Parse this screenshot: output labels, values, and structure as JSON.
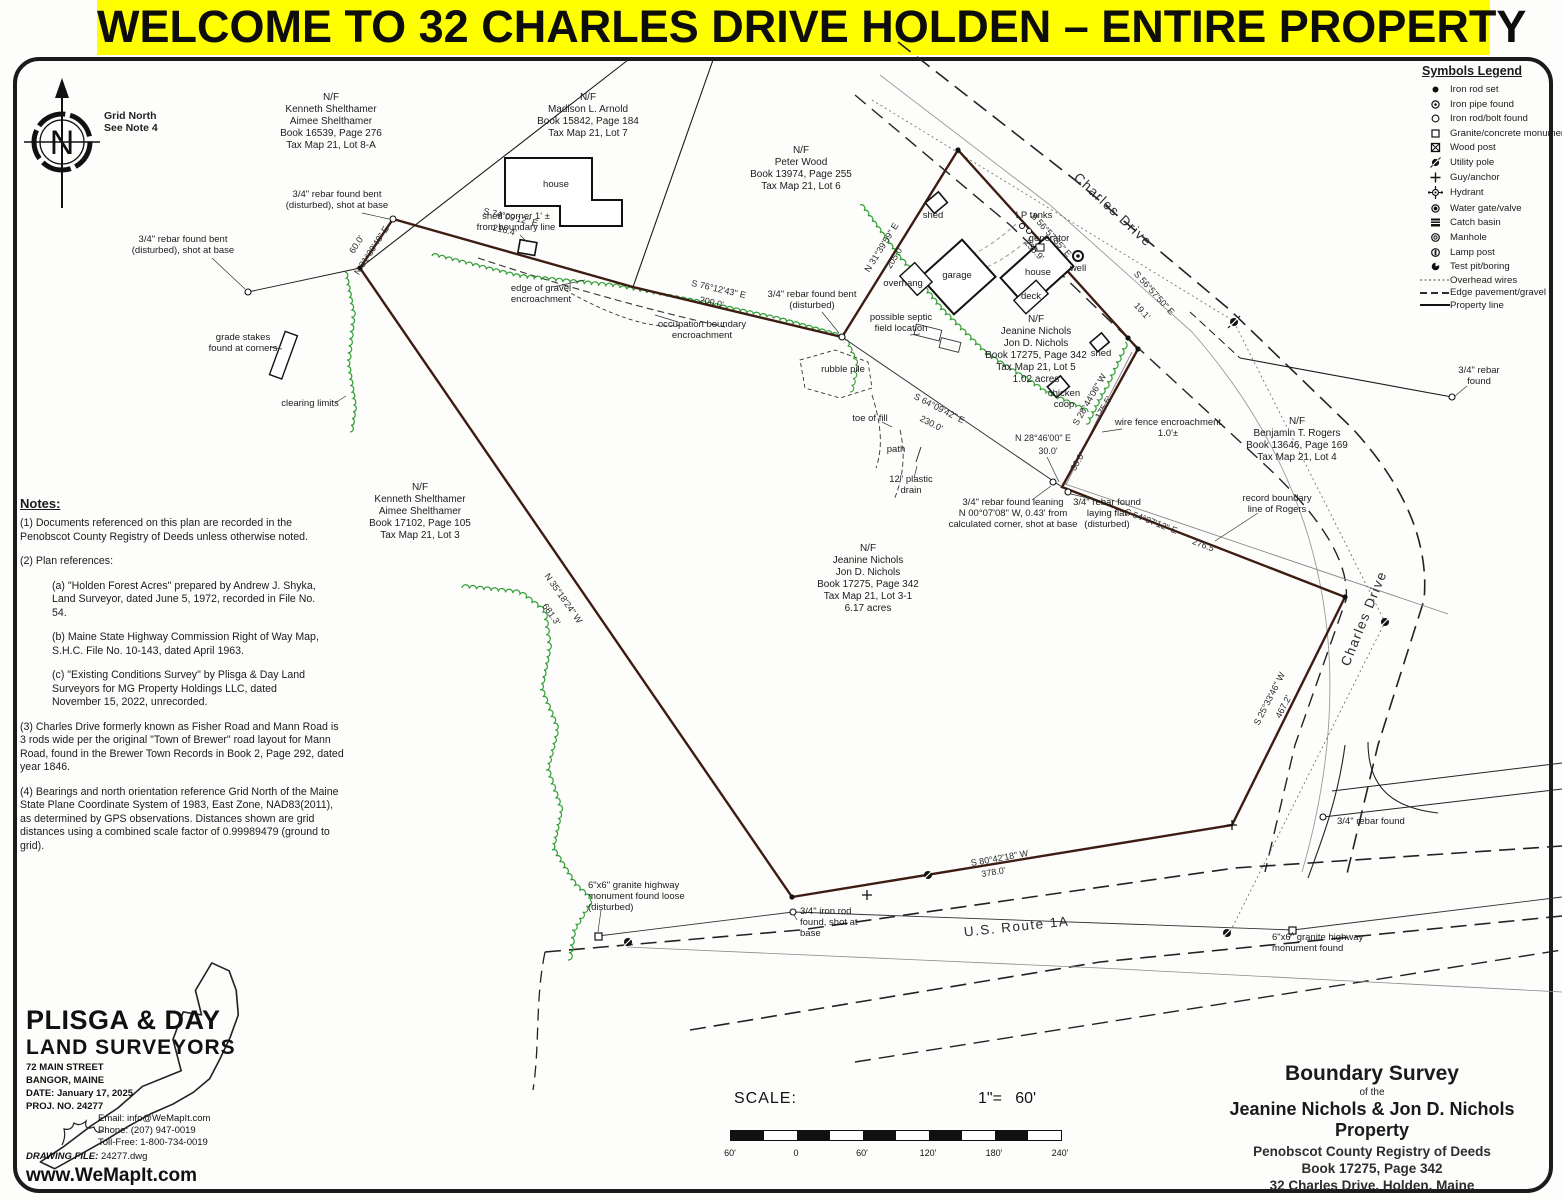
{
  "banner": {
    "text": "WELCOME TO 32 CHARLES DRIVE HOLDEN – ENTIRE PROPERTY"
  },
  "compass": {
    "letter": "N",
    "caption1": "Grid North",
    "caption2": "See Note 4"
  },
  "legend": {
    "title": "Symbols Legend",
    "items": [
      {
        "icon": "iron-rod-set",
        "label": "Iron rod set"
      },
      {
        "icon": "iron-pipe-found",
        "label": "Iron pipe found"
      },
      {
        "icon": "iron-rod-bolt-found",
        "label": "Iron rod/bolt found"
      },
      {
        "icon": "granite-concrete-monument",
        "label": "Granite/concrete monument"
      },
      {
        "icon": "wood-post",
        "label": "Wood post"
      },
      {
        "icon": "utility-pole",
        "label": "Utility pole"
      },
      {
        "icon": "guy-anchor",
        "label": "Guy/anchor"
      },
      {
        "icon": "hydrant",
        "label": "Hydrant"
      },
      {
        "icon": "water-gate-valve",
        "label": "Water gate/valve"
      },
      {
        "icon": "catch-basin",
        "label": "Catch basin"
      },
      {
        "icon": "manhole",
        "label": "Manhole"
      },
      {
        "icon": "lamp-post",
        "label": "Lamp post"
      },
      {
        "icon": "test-pit-boring",
        "label": "Test pit/boring"
      },
      {
        "icon": "overhead-wires",
        "label": "Overhead wires"
      },
      {
        "icon": "edge-pavement-gravel",
        "label": "Edge pavement/gravel"
      },
      {
        "icon": "property-line",
        "label": "Property line"
      }
    ]
  },
  "notes": {
    "title": "Notes:",
    "items": [
      {
        "text": "(1)  Documents referenced on this plan are recorded in the Penobscot County Registry of Deeds unless otherwise noted."
      },
      {
        "text": "(2) Plan references:"
      },
      {
        "text": "(a) \"Holden Forest Acres\" prepared by Andrew J. Shyka, Land Surveyor, dated June 5, 1972, recorded in File No. 54."
      },
      {
        "text": "(b) Maine State Highway Commission Right of Way Map, S.H.C. File No. 10-143, dated April 1963."
      },
      {
        "text": "(c) \"Existing Conditions Survey\" by Plisga & Day Land Surveyors for MG Property Holdings LLC, dated November 15, 2022, unrecorded."
      },
      {
        "text": "(3) Charles Drive formerly known as Fisher Road and Mann Road is 3 rods wide per the original \"Town of Brewer\" road layout for Mann Road, found in the Brewer Town Records in Book 2, Page 292, dated year 1846."
      },
      {
        "text": "(4) Bearings and north orientation reference Grid North of the Maine State Plane Coordinate System of 1983, East Zone, NAD83(2011), as determined by GPS observations. Distances shown are grid distances using a combined scale factor of 0.99989479 (ground to grid)."
      }
    ]
  },
  "firm": {
    "name1": "PLISGA & DAY",
    "name2": "LAND SURVEYORS",
    "addr1": "72 MAIN STREET",
    "addr2": "BANGOR, MAINE",
    "date_label": "DATE:",
    "date_value": "January 17, 2025",
    "proj_label": "PROJ. NO.",
    "proj_value": "24277",
    "email": "Email: info@WeMapIt.com",
    "phone": "Phone: (207) 947-0019",
    "tollfree": "Toll-Free: 1-800-734-0019",
    "file_label": "DRAWING FILE:",
    "file_value": "24277.dwg",
    "website": "www.WeMapIt.com"
  },
  "scale": {
    "label": "SCALE:",
    "ratio": "1\"=   60'",
    "ticks": [
      "60'",
      "0",
      "60'",
      "120'",
      "180'",
      "240'"
    ]
  },
  "title_block": {
    "l1": "Boundary Survey",
    "l2": "of the",
    "l3": "Jeanine Nichols & Jon D. Nichols Property",
    "l4": "Penobscot County Registry of Deeds",
    "l5": "Book 17275, Page 342",
    "l6": "32 Charles Drive, Holden, Maine"
  },
  "map": {
    "roads": {
      "charles": "Charles Drive",
      "route1a": "U.S. Route 1A"
    },
    "p": {
      "lot8a": [
        "N/F",
        "Kenneth Shelthamer",
        "Aimee Shelthamer",
        "Book 16539, Page 276",
        "Tax Map 21, Lot 8-A"
      ],
      "lot7": [
        "N/F",
        "Madison L. Arnold",
        "Book 15842, Page 184",
        "Tax Map 21, Lot 7"
      ],
      "lot6": [
        "N/F",
        "Peter Wood",
        "Book 13974, Page 255",
        "Tax Map 21, Lot 6"
      ],
      "lot5": [
        "N/F",
        "Jeanine Nichols",
        "Jon D. Nichols",
        "Book 17275, Page 342",
        "Tax Map 21, Lot 5",
        "1.02 acres"
      ],
      "lot4": [
        "N/F",
        "Benjamin T. Rogers",
        "Book 13646, Page 169",
        "Tax Map 21, Lot 4"
      ],
      "lot3": [
        "N/F",
        "Kenneth Shelthamer",
        "Aimee Shelthamer",
        "Book 17102, Page 105",
        "Tax Map 21, Lot 3"
      ],
      "lot31": [
        "N/F",
        "Jeanine Nichols",
        "Jon D. Nichols",
        "Book 17275, Page 342",
        "Tax Map 21, Lot 3-1",
        "6.17 acres"
      ]
    },
    "a": {
      "rebar_bent1": "3/4\" rebar found bent",
      "rebar_bent2": "(disturbed), shot at base",
      "disturbed": "(disturbed)",
      "shed_corner1": "shed corner 1' ±",
      "shed_corner2": "from boundary line",
      "gravel1": "edge of gravel",
      "occ1": "occupation boundary",
      "encroach": "encroachment",
      "septic1": "possible septic",
      "septic2": "field location",
      "rubble": "rubble pile",
      "stakes1": "grade stakes",
      "stakes2": "found at corners",
      "clearing": "clearing limits",
      "toe": "toe of fill",
      "path": "path",
      "drain1": "12\" plastic",
      "drain2": "drain",
      "fence1": "wire fence encroachment",
      "fence2": "1.0'±",
      "record1": "record boundary",
      "record2": "line of Rogers",
      "lean1": "3/4\" rebar found leaning",
      "lean2": "N 00°07'08\" W, 0.43' from",
      "lean3": "calculated corner, shot at base",
      "flat1": "3/4\" rebar found",
      "flat2": "laying flat",
      "rebar_r1": "3/4\" rebar",
      "rebar_r2": "found",
      "gmon1": "6\"x6\" granite highway",
      "gmon2": "monument found loose",
      "gmon3": "monument found",
      "irod1": "3/4\" iron rod",
      "irod2": "found, shot at",
      "irod3": "base",
      "bld_house": "house",
      "bld_shed": "shed",
      "bld_lp": "LP tanks",
      "bld_gen": "generator",
      "bld_well": "well",
      "bld_over": "overhang",
      "bld_garage": "garage",
      "bld_deck": "deck",
      "bld_coop1": "chicken",
      "bld_coop2": "coop"
    },
    "b": {
      "b0": {
        "b": "S 74°09'12\" E",
        "d": "216.4'"
      },
      "b1": {
        "b": "N 31°30'48\" E",
        "d": "60.0'"
      },
      "b2": {
        "b": "S 76°12'43\" E",
        "d": "200.0'"
      },
      "b3": {
        "b": "N 31°39'59\" E",
        "d": "205.0'"
      },
      "b4": {
        "b": "S 56°57'35\" E",
        "d": "235.9'"
      },
      "b5": {
        "b": "S 56°57'50\" E",
        "d": "19.1'"
      },
      "b6": {
        "b": "S 28°44'06\" W",
        "d": "175.5'"
      },
      "b7": {
        "b": "N 28°46'00\" E",
        "d": "30.0'"
      },
      "b9": {
        "b": "S 64°09'42\" E",
        "d": "230.0'"
      },
      "b10": {
        "b": "S 64°07'12\" E",
        "d": "276.5'"
      },
      "b11": {
        "b": "N 35°18'24\" W",
        "d": "681.3'"
      },
      "b12": {
        "b": "S 25°33'46\" W",
        "d": "467.2'"
      },
      "b13": {
        "b": "S 80°42'18\" W",
        "d": "378.0'"
      }
    }
  }
}
